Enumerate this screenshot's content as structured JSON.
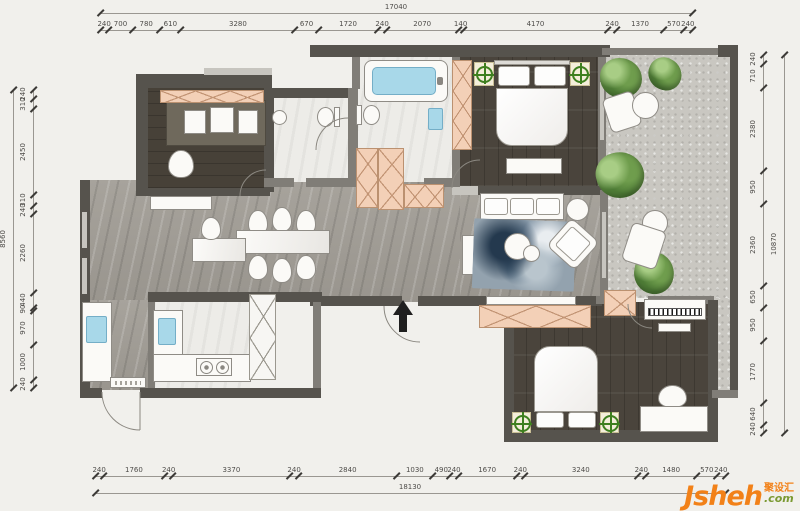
{
  "watermark": {
    "brand": "Jsheh",
    "cn": "聚设汇",
    "suffix": ".com"
  },
  "dimensions": {
    "top": {
      "overall": "17040",
      "segments": [
        "240",
        "700",
        "780",
        "610",
        "3280",
        "670",
        "1720",
        "240",
        "2070",
        "140",
        "4170",
        "240",
        "1370",
        "570",
        "240"
      ]
    },
    "bottom": {
      "overall": "18130",
      "segments": [
        "240",
        "1760",
        "240",
        "3370",
        "240",
        "2840",
        "1030",
        "490",
        "240",
        "1670",
        "240",
        "3240",
        "240",
        "1480",
        "570",
        "240"
      ]
    },
    "left": {
      "overall": "8560",
      "segments": [
        "240",
        "310",
        "2450",
        "310",
        "240",
        "2260",
        "440",
        "90",
        "970",
        "1000",
        "240"
      ]
    },
    "right": {
      "overall": "10870",
      "segments": [
        "240",
        "710",
        "2380",
        "950",
        "2360",
        "650",
        "950",
        "1770",
        "640",
        "240"
      ]
    }
  },
  "colors": {
    "wall": "#56534d",
    "wood_floor": "#4a443c",
    "marble_floor": "#a19d96",
    "gravel": "#c9c7c1",
    "cabinet_pink": "#f3d0b7",
    "water_blue": "#a8d8e9",
    "plant_green": "#618c44",
    "marker_green": "#3e7f1f",
    "brand_orange": "#f28118",
    "brand_suffix_green": "#7b9a33"
  }
}
